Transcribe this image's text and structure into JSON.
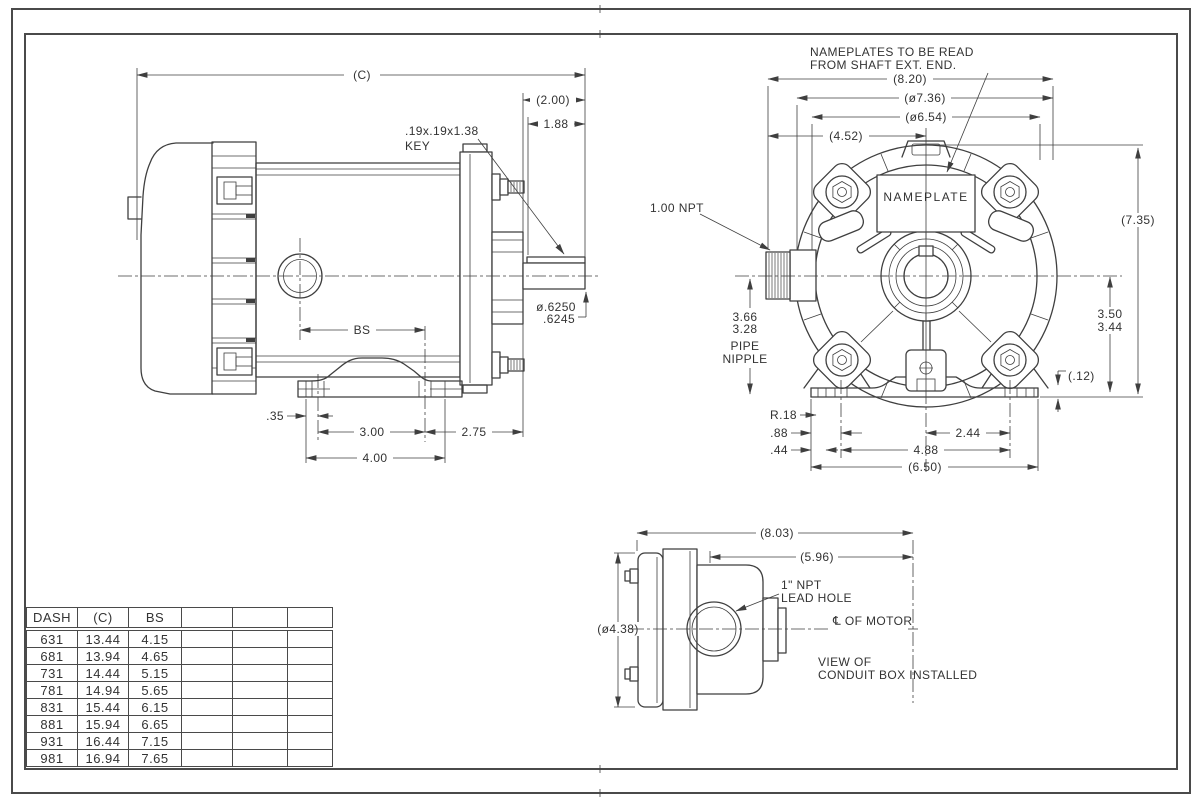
{
  "colors": {
    "ink": "#3f3f3f",
    "background": "#ffffff"
  },
  "drawing": {
    "side_view": {
      "dim_c": "(C)",
      "dim_200": "(2.00)",
      "dim_188": "1.88",
      "key_note_line1": ".19x.19x1.38",
      "key_note_line2": "KEY",
      "dim_bs": "BS",
      "shaft_dia_line1": "ø.6250",
      "shaft_dia_line2": ".6245",
      "dim_35": ".35",
      "dim_300": "3.00",
      "dim_275": "2.75",
      "dim_400": "4.00"
    },
    "front_view": {
      "note_line1": "NAMEPLATES TO BE READ",
      "note_line2": "FROM SHAFT EXT. END.",
      "dim_820": "(8.20)",
      "dim_736": "(ø7.36)",
      "dim_654": "(ø6.54)",
      "dim_452": "(4.52)",
      "nameplate": "NAMEPLATE",
      "npt": "1.00 NPT",
      "dim_735": "(7.35)",
      "nipple_line1": "3.66",
      "nipple_line2": "3.28",
      "nipple_line3": "PIPE",
      "nipple_line4": "NIPPLE",
      "dim_350": "3.50",
      "dim_344": "3.44",
      "dim_12": "(.12)",
      "dim_r18": "R.18",
      "dim_88": ".88",
      "dim_44": ".44",
      "dim_244": "2.44",
      "dim_488": "4.88",
      "dim_650": "(6.50)"
    },
    "conduit_view": {
      "dim_803": "(8.03)",
      "dim_596": "(5.96)",
      "dim_438": "(ø4.38)",
      "lead_hole_line1": "1\" NPT",
      "lead_hole_line2": "LEAD HOLE",
      "centerline_label": "℄ OF MOTOR",
      "caption_line1": "VIEW OF",
      "caption_line2": "CONDUIT BOX INSTALLED"
    }
  },
  "table": {
    "headers": [
      "DASH",
      "(C)",
      "BS",
      "",
      "",
      ""
    ],
    "rows": [
      [
        "631",
        "13.44",
        "4.15"
      ],
      [
        "681",
        "13.94",
        "4.65"
      ],
      [
        "731",
        "14.44",
        "5.15"
      ],
      [
        "781",
        "14.94",
        "5.65"
      ],
      [
        "831",
        "15.44",
        "6.15"
      ],
      [
        "881",
        "15.94",
        "6.65"
      ],
      [
        "931",
        "16.44",
        "7.15"
      ],
      [
        "981",
        "16.94",
        "7.65"
      ]
    ]
  }
}
